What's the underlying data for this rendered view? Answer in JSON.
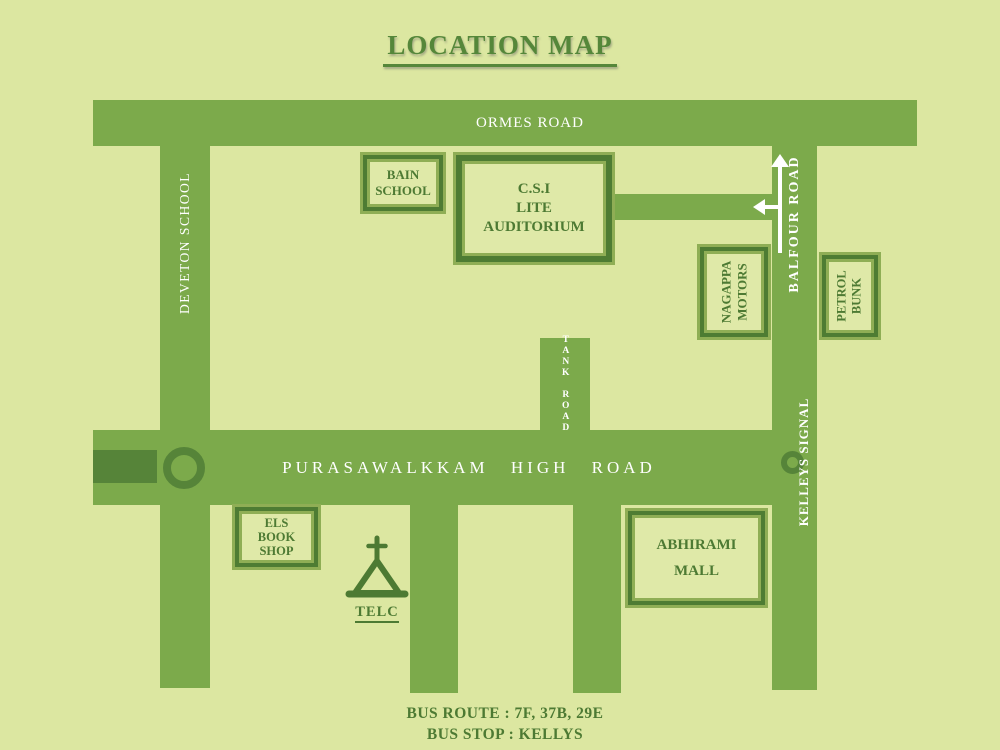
{
  "title": "LOCATION MAP",
  "colors": {
    "background": "#dce7a1",
    "road": "#7caa4b",
    "dark_accent": "#568439",
    "border_dark": "#4e7c33",
    "border_light": "#8fae55",
    "text_green": "#4d7a33",
    "road_text": "#ffffff"
  },
  "roads": {
    "ormes": {
      "label": "ORMES ROAD"
    },
    "deveton": {
      "label": "DEVETON SCHOOL"
    },
    "balfour": {
      "label": "BALFOUR ROAD"
    },
    "kelleys": {
      "label": "KELLEYS SIGNAL"
    },
    "tank": {
      "label": "TANK ROAD"
    },
    "high": {
      "label": "PURASAWALKKAM HIGH ROAD"
    }
  },
  "pois": {
    "bain": {
      "lines": [
        "BAIN",
        "SCHOOL"
      ]
    },
    "csi": {
      "lines": [
        "C.S.I",
        "LITE",
        "AUDITORIUM"
      ]
    },
    "nagappa": {
      "lines": [
        "NAGAPPA",
        "MOTORS"
      ]
    },
    "petrol": {
      "lines": [
        "PETROL",
        "BUNK"
      ]
    },
    "els": {
      "lines": [
        "ELS",
        "BOOK",
        "SHOP"
      ]
    },
    "abhirami": {
      "lines": [
        "ABHIRAMI",
        "MALL"
      ]
    },
    "telc": {
      "label": "TELC"
    }
  },
  "footer": {
    "bus_route": "BUS ROUTE : 7F, 37B, 29E",
    "bus_stop": "BUS STOP : KELLYS"
  }
}
